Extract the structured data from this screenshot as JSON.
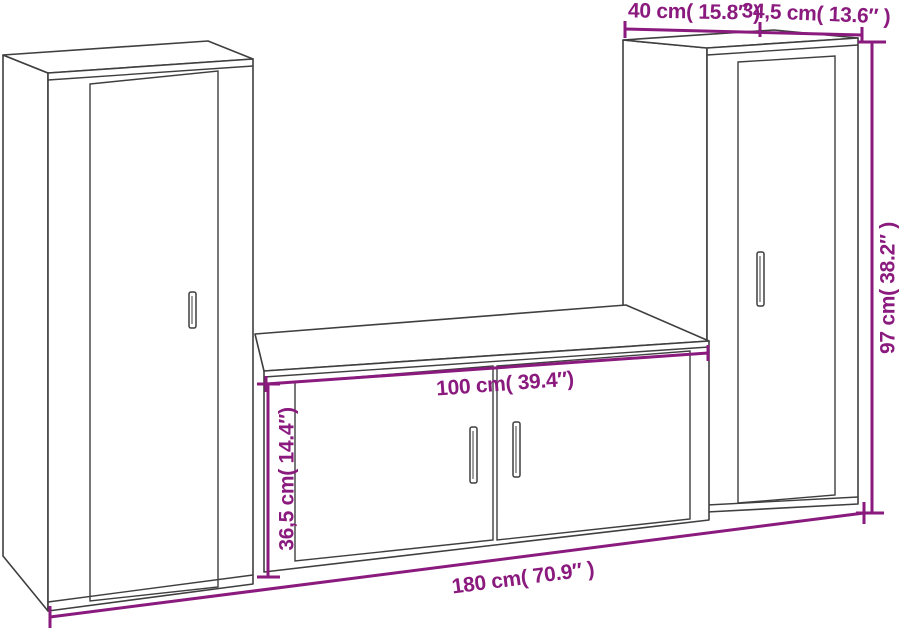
{
  "diagram": {
    "title": "3-piece TV wall cabinet set — dimension diagram",
    "background": "#ffffff",
    "outline_color": "#3f3f3f",
    "dimension_color": "#8a1a7d",
    "dimensions": {
      "cabinet_width": {
        "label": "40 cm( 15.8″ )",
        "cm": "40",
        "inches": "15.8"
      },
      "cabinet_depth": {
        "label": "34,5 cm( 13.6″ )",
        "cm": "34,5",
        "inches": "13.6"
      },
      "cabinet_height": {
        "label": "97 cm( 38.2″ )",
        "cm": "97",
        "inches": "38.2"
      },
      "bench_width": {
        "label": "100 cm( 39.4″)",
        "cm": "100",
        "inches": "39.4"
      },
      "bench_height": {
        "label": "36,5 cm( 14.4″)",
        "cm": "36,5",
        "inches": "14.4"
      },
      "total_width": {
        "label": "180 cm( 70.9″ )",
        "cm": "180",
        "inches": "70.9"
      }
    },
    "parts": [
      {
        "name": "left tall cabinet"
      },
      {
        "name": "center TV bench"
      },
      {
        "name": "right tall cabinet"
      }
    ]
  }
}
